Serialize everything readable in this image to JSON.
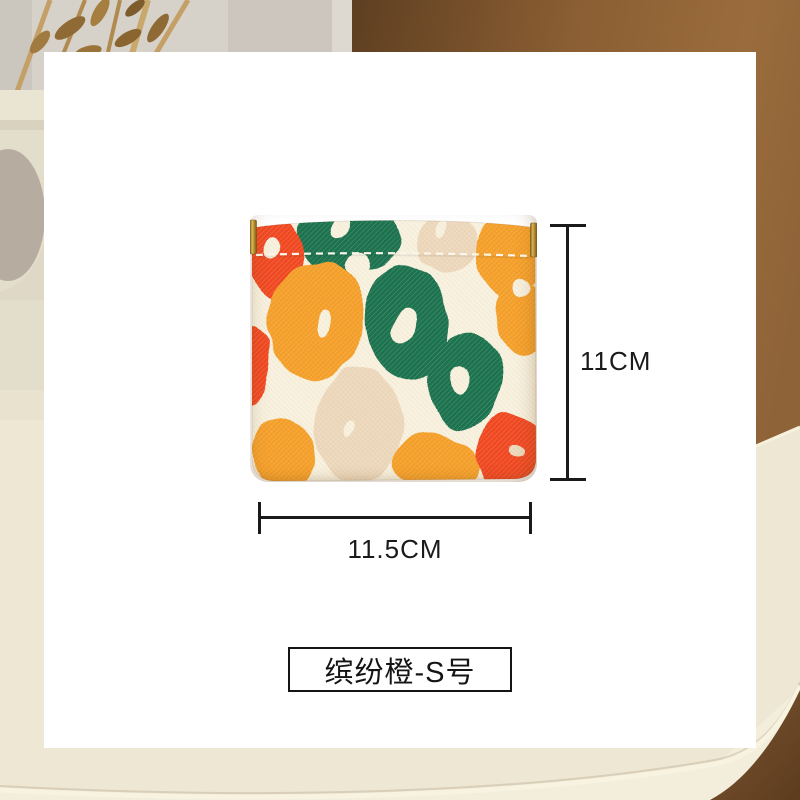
{
  "product": {
    "description": "small squeeze-top coin pouch with multicolor leopard blob print",
    "variant_label": "缤纷橙-S号",
    "height_label": "11CM",
    "width_label": "11.5CM"
  },
  "colors": {
    "card_background": "#FFFFFF",
    "pouch_base": "#F8F1DE",
    "pattern_orange": "#F5A02C",
    "pattern_green": "#1F7350",
    "pattern_red": "#F14A22",
    "pattern_cream": "#EDD8BC",
    "clasp_gold": "#C29B35",
    "dimension_line": "#1A1A1A",
    "wall_greige": "#D6D1C9",
    "door_brown": "#8B5E33",
    "table_cream": "#EEE7D4"
  }
}
